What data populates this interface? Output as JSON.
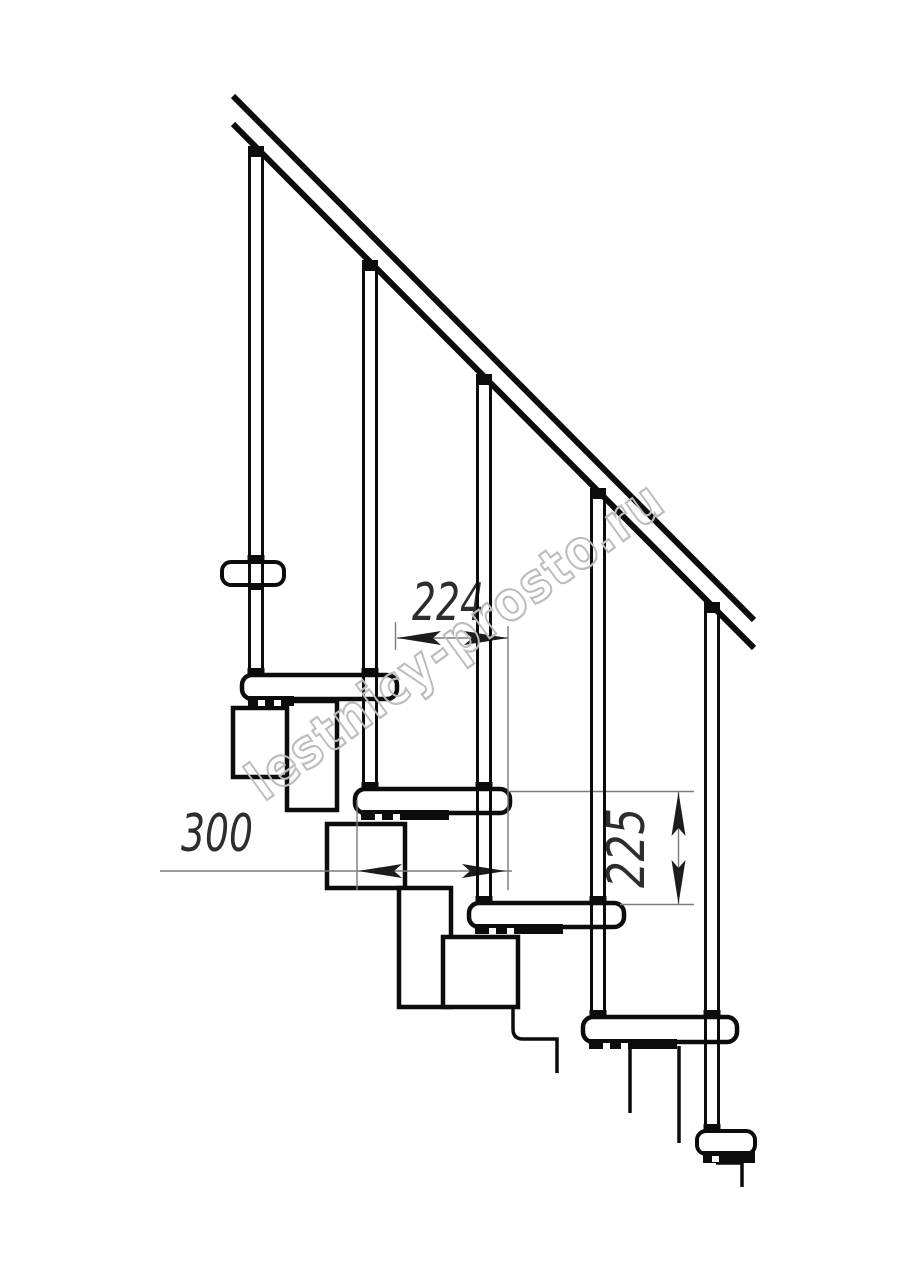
{
  "document": {
    "title": "Modular staircase side elevation drawing",
    "background": "#ffffff"
  },
  "watermark": {
    "text": "lestnicy-prosto.ru",
    "color": "#bcbcbc"
  },
  "annotations": {
    "going_width": "224",
    "tread_depth": "300",
    "step_rise": "225"
  },
  "palette": {
    "ink": "#0c0c0c",
    "dimension_line": "#7b7b7b",
    "dimension_text": "#2d2d2d",
    "arrow": "#1c1c1c"
  }
}
